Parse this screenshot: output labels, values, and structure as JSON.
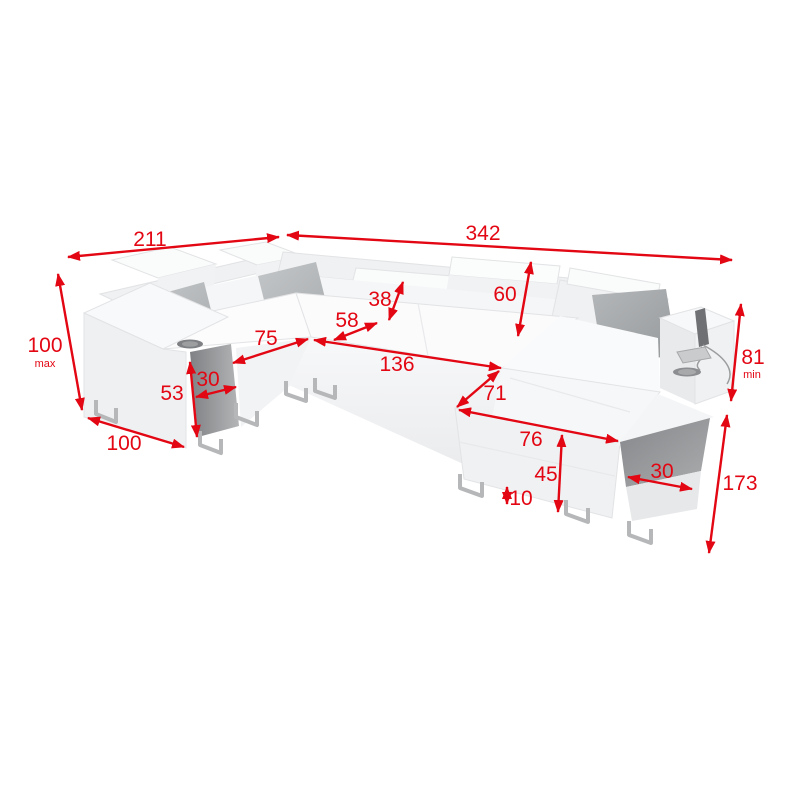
{
  "diagram": {
    "type": "furniture-dimension-diagram",
    "subject": "u-shaped-corner-sofa",
    "colors": {
      "background": "#ffffff",
      "dimension_accent": "#e30613",
      "sofa_body": "#f6f7f8",
      "pillow": "#b7babc",
      "dark_side_panel": "#85878a",
      "glass_shelf": "#8d9093",
      "metal_leg": "#b5b7b9"
    },
    "dimensions": {
      "overall_width_left": {
        "value": "211"
      },
      "overall_width_right": {
        "value": "342"
      },
      "back_height": {
        "value": "100",
        "suffix": "max"
      },
      "left_side_depth": {
        "value": "100"
      },
      "left_shelf_height": {
        "value": "53"
      },
      "left_shelf_depth": {
        "value": "30"
      },
      "left_seat_width": {
        "value": "75"
      },
      "seat_depth": {
        "value": "58"
      },
      "headrest_height": {
        "value": "38"
      },
      "backrest_height": {
        "value": "60"
      },
      "middle_seat_width": {
        "value": "136"
      },
      "chaise_width": {
        "value": "71"
      },
      "bed_front_width": {
        "value": "76"
      },
      "bed_front_height": {
        "value": "45"
      },
      "floor_clearance": {
        "value": "10"
      },
      "right_shelf_depth": {
        "value": "30"
      },
      "armrest_height": {
        "value": "81",
        "suffix": "min"
      },
      "overall_depth_right": {
        "value": "173"
      }
    }
  }
}
